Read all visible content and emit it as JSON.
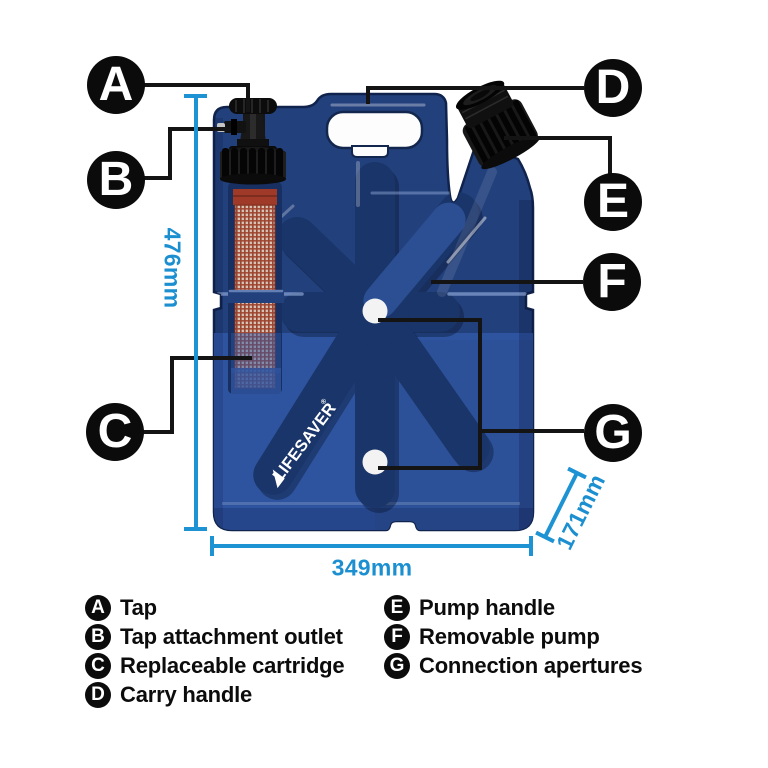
{
  "product": {
    "brand": "LIFESAVER",
    "brand_mark": "®",
    "type_note": "jerrycan water filter cutaway diagram"
  },
  "dimensions": {
    "height_label": "476mm",
    "width_label": "349mm",
    "depth_label": "171mm"
  },
  "callouts": [
    {
      "letter": "A",
      "label": "Tap"
    },
    {
      "letter": "B",
      "label": "Tap attachment outlet"
    },
    {
      "letter": "C",
      "label": "Replaceable cartridge"
    },
    {
      "letter": "D",
      "label": "Carry handle"
    },
    {
      "letter": "E",
      "label": "Pump handle"
    },
    {
      "letter": "F",
      "label": "Removable pump"
    },
    {
      "letter": "G",
      "label": "Connection apertures"
    }
  ],
  "colors": {
    "body_blue_dark": "#22407c",
    "body_blue_light": "#2e54a0",
    "recess_blue": "#1a3569",
    "accent_cyan": "#1d93d4",
    "marker_black": "#0b0b0b",
    "cartridge_red": "#9e3a27",
    "mesh_beige": "#ddd5c8"
  }
}
